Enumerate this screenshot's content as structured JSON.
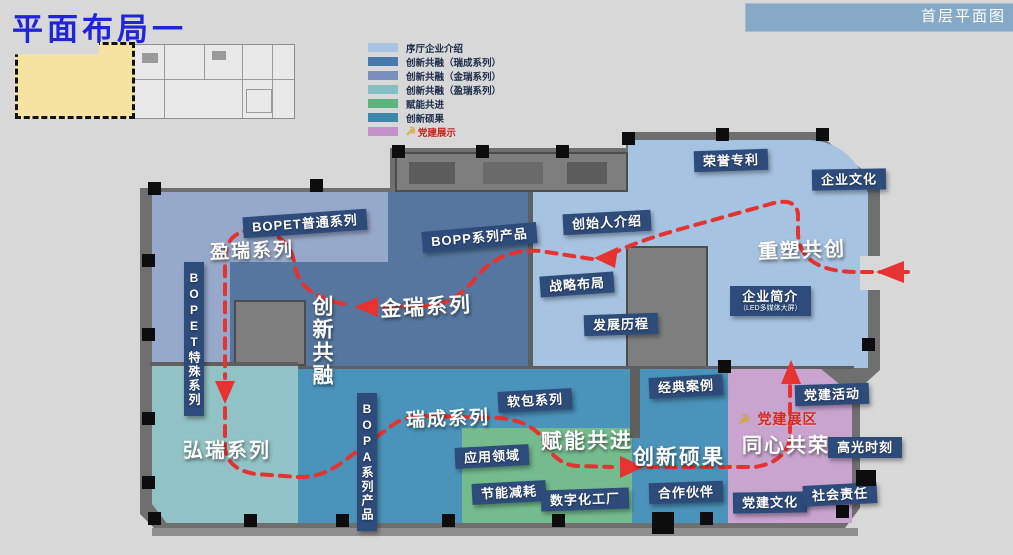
{
  "page": {
    "title": "平面布局一",
    "corner_tab": "首层平面图"
  },
  "legend": {
    "items": [
      {
        "label": "序厅企业介绍",
        "color": "#a7c4e2"
      },
      {
        "label": "创新共融（瑞成系列）",
        "color": "#4679ae"
      },
      {
        "label": "创新共融（金瑞系列）",
        "color": "#7b8fbe"
      },
      {
        "label": "创新共融（盈瑞系列）",
        "color": "#85bfc3"
      },
      {
        "label": "赋能共进",
        "color": "#5cb57e"
      },
      {
        "label": "创新硕果",
        "color": "#3d87ad"
      },
      {
        "label": "党建展示",
        "color": "#c491c9",
        "text_color": "#c9251f",
        "icon": "party-emblem"
      }
    ]
  },
  "map": {
    "zones": [
      {
        "name": "序厅企业介绍区",
        "color": "#a6c3e1"
      },
      {
        "name": "盈瑞系列区",
        "color": "#97a9cb"
      },
      {
        "name": "金瑞系列区",
        "color": "#55779f"
      },
      {
        "name": "弘瑞系列区",
        "color": "#91c2c5"
      },
      {
        "name": "瑞成系列·创新硕果区",
        "color": "#4a93ba"
      },
      {
        "name": "赋能共进区",
        "color": "#74bc8d"
      },
      {
        "name": "党建展示区",
        "color": "#c9a4cf"
      }
    ],
    "route_color": "#e63230",
    "party_icon": "☭",
    "labels": [
      {
        "text": "荣誉专利"
      },
      {
        "text": "企业文化"
      },
      {
        "text": "创始人介绍"
      },
      {
        "text": "战略布局"
      },
      {
        "text": "发展历程"
      },
      {
        "text": "企业简介",
        "sub": "（LED多媒体大屏）"
      },
      {
        "text": "重塑共创"
      },
      {
        "text": "BOPET普通系列"
      },
      {
        "text": "盈瑞系列"
      },
      {
        "text": "BOPP系列产品"
      },
      {
        "text": "BOPET特殊系列"
      },
      {
        "text": "金瑞系列"
      },
      {
        "text": "创新共融"
      },
      {
        "text": "弘瑞系列"
      },
      {
        "text": "BOPA系列产品"
      },
      {
        "text": "瑞成系列"
      },
      {
        "text": "软包系列"
      },
      {
        "text": "应用领域"
      },
      {
        "text": "节能减耗"
      },
      {
        "text": "数字化工厂"
      },
      {
        "text": "赋能共进"
      },
      {
        "text": "经典案例"
      },
      {
        "text": "创新硕果"
      },
      {
        "text": "合作伙伴"
      },
      {
        "text": "党建活动"
      },
      {
        "text": "党建展区"
      },
      {
        "text": "同心共荣"
      },
      {
        "text": "高光时刻"
      },
      {
        "text": "党建文化"
      },
      {
        "text": "社会责任"
      }
    ]
  }
}
